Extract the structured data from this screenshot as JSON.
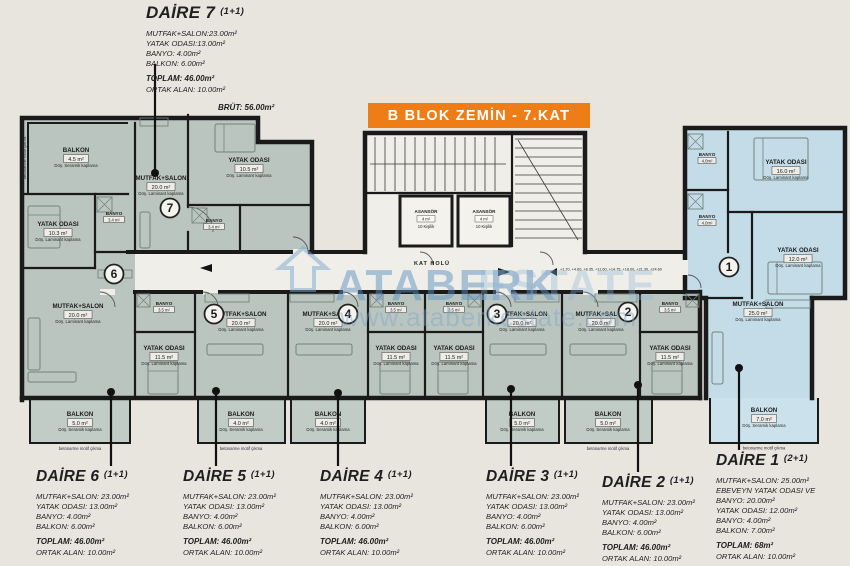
{
  "banner": {
    "title": "B BLOK ZEMİN - 7.KAT",
    "bg_color": "#ee7d17"
  },
  "watermark": {
    "brand_left": "ATABERK",
    "brand_right": "ESTATE",
    "url": "www.ataberkestate.com",
    "color": "#6f9ec7"
  },
  "units": [
    {
      "name": "DAİRE 7",
      "type": "(1+1)",
      "details": [
        "MUTFAK+SALON:23.00m²",
        "YATAK ODASI:13.00m²",
        "BANYO: 4.00m²",
        "BALKON: 6.00m²"
      ],
      "toplam": "TOPLAM: 46.00m²",
      "ortak": "ORTAK ALAN: 10.00m²",
      "brut": "BRÜT: 56.00m²"
    },
    {
      "name": "DAİRE 6",
      "type": "(1+1)",
      "details": [
        "MUTFAK+SALON: 23.00m²",
        "YATAK ODASI: 13.00m²",
        "BANYO: 4.00m²",
        "BALKON: 6.00m²"
      ],
      "toplam": "TOPLAM: 46.00m²",
      "ortak": "ORTAK ALAN: 10.00m²"
    },
    {
      "name": "DAİRE 5",
      "type": "(1+1)",
      "details": [
        "MUTFAK+SALON: 23.00m²",
        "YATAK ODASI: 13.00m²",
        "BANYO: 4.00m²",
        "BALKON: 6.00m²"
      ],
      "toplam": "TOPLAM: 46.00m²",
      "ortak": "ORTAK ALAN: 10.00m²"
    },
    {
      "name": "DAİRE 4",
      "type": "(1+1)",
      "details": [
        "MUTFAK+SALON: 23.00m²",
        "YATAK ODASI: 13.00m²",
        "BANYO: 4.00m²",
        "BALKON: 6.00m²"
      ],
      "toplam": "TOPLAM: 46.00m²",
      "ortak": "ORTAK ALAN: 10.00m²"
    },
    {
      "name": "DAİRE 3",
      "type": "(1+1)",
      "details": [
        "MUTFAK+SALON: 23.00m²",
        "YATAK ODASI: 13.00m²",
        "BANYO: 4.00m²",
        "BALKON: 6.00m²"
      ],
      "toplam": "TOPLAM: 46.00m²",
      "ortak": "ORTAK ALAN: 10.00m²"
    },
    {
      "name": "DAİRE 2",
      "type": "(1+1)",
      "details": [
        "MUTFAK+SALON: 23.00m²",
        "YATAK ODASI: 13.00m²",
        "BANYO: 4.00m²",
        "BALKON: 6.00m²"
      ],
      "toplam": "TOPLAM: 46.00m²",
      "ortak": "ORTAK ALAN: 10.00m²"
    },
    {
      "name": "DAİRE 1",
      "type": "(2+1)",
      "details": [
        "MUTFAK+SALON: 25.00m²",
        "EBEVEYN YATAK ODASI VE",
        "BANYO: 20.00m²",
        "YATAK ODASI: 12.00m²",
        "BANYO: 4.00m²",
        "BALKON: 7.00m²"
      ],
      "toplam": "TOPLAM: 68m²",
      "ortak": "ORTAK ALAN: 10.00m²"
    }
  ],
  "plan": {
    "corridor_label": "KAT HOLÜ",
    "elevations": "+1.70, +4.60, +8.35, +11.60, +14.75, +18.00, +21.30, +24.60",
    "elevator_lines": [
      "ASANSÖR",
      "4 m²",
      "10 Kişilik"
    ],
    "edge_note": "betonarme motif çıkma",
    "numbers": {
      "apt7": "7",
      "apt6": "6",
      "apt5": "5",
      "apt4": "4",
      "apt3": "3",
      "apt2": "2",
      "apt1": "1"
    },
    "colors": {
      "wall": "#1a1a1a",
      "room_fill": "#bac5bf",
      "highlight_fill": "#c3dce8",
      "paper": "#efeee8"
    },
    "rooms": [
      {
        "label": "BALKON",
        "area": "4.5 m²",
        "note": "Döş. Seramik kaplama"
      },
      {
        "label": "MUTFAK+SALON",
        "area": "20.0 m²",
        "note": "Döş. Laminant kaplama"
      },
      {
        "label": "YATAK ODASI",
        "area": "10.5 m²",
        "note": "Döş. Laminant kaplama"
      },
      {
        "label": "BANYO",
        "area": "3.4 m²",
        "note": ""
      },
      {
        "label": "YATAK ODASI",
        "area": "10.3 m²",
        "note": "Döş. Laminant kaplama"
      },
      {
        "label": "BANYO",
        "area": "3.4 m²",
        "note": ""
      },
      {
        "label": "MUTFAK+SALON",
        "area": "20.0 m²",
        "note": "Döş. Laminant kaplama"
      },
      {
        "label": "BALKON",
        "area": "5.0 m²",
        "note": "Döş. Seramik kaplama"
      },
      {
        "label": "BANYO",
        "area": "3.5 m²",
        "note": ""
      },
      {
        "label": "YATAK ODASI",
        "area": "11.5 m²",
        "note": "Döş. Laminant kaplama"
      },
      {
        "label": "MUTFAK+SALON",
        "area": "20.0 m²",
        "note": "Döş. Laminant kaplama"
      },
      {
        "label": "BALKON",
        "area": "4.0 m²",
        "note": "Döş. Seramik kaplama"
      },
      {
        "label": "MUTFAK+SALON",
        "area": "20.0 m²",
        "note": "Döş. Laminant kaplama"
      },
      {
        "label": "BANYO",
        "area": "3.5 m²",
        "note": ""
      },
      {
        "label": "YATAK ODASI",
        "area": "11.5 m²",
        "note": "Döş. Laminant kaplama"
      },
      {
        "label": "BALKON",
        "area": "4.0 m²",
        "note": "Döş. Seramik kaplama"
      },
      {
        "label": "BANYO",
        "area": "3.5 m²",
        "note": ""
      },
      {
        "label": "YATAK ODASI",
        "area": "11.5 m²",
        "note": "Döş. Laminant kaplama"
      },
      {
        "label": "MUTFAK+SALON",
        "area": "20.0 m²",
        "note": "Döş. Laminant kaplama"
      },
      {
        "label": "BALKON",
        "area": "5.0 m²",
        "note": "Döş. Seramik kaplama"
      },
      {
        "label": "MUTFAK+SALON",
        "area": "20.0 m²",
        "note": "Döş. Laminant kaplama"
      },
      {
        "label": "BANYO",
        "area": "3.5 m²",
        "note": ""
      },
      {
        "label": "YATAK ODASI",
        "area": "11.5 m²",
        "note": "Döş. Laminant kaplama"
      },
      {
        "label": "BALKON",
        "area": "5.0 m²",
        "note": "Döş. Seramik kaplama"
      },
      {
        "label": "BANYO",
        "area": "4.0m²",
        "note": ""
      },
      {
        "label": "BANYO",
        "area": "4.0m²",
        "note": ""
      },
      {
        "label": "YATAK ODASI",
        "area": "16.0 m²",
        "note": "Döş. Laminant kaplama"
      },
      {
        "label": "YATAK ODASI",
        "area": "12.0 m²",
        "note": "Döş. Laminant kaplama"
      },
      {
        "label": "MUTFAK+SALON",
        "area": "25.0 m²",
        "note": "Döş. Laminant kaplama"
      },
      {
        "label": "BALKON",
        "area": "7.0 m²",
        "note": "Döş. Seramik kaplama"
      }
    ]
  }
}
